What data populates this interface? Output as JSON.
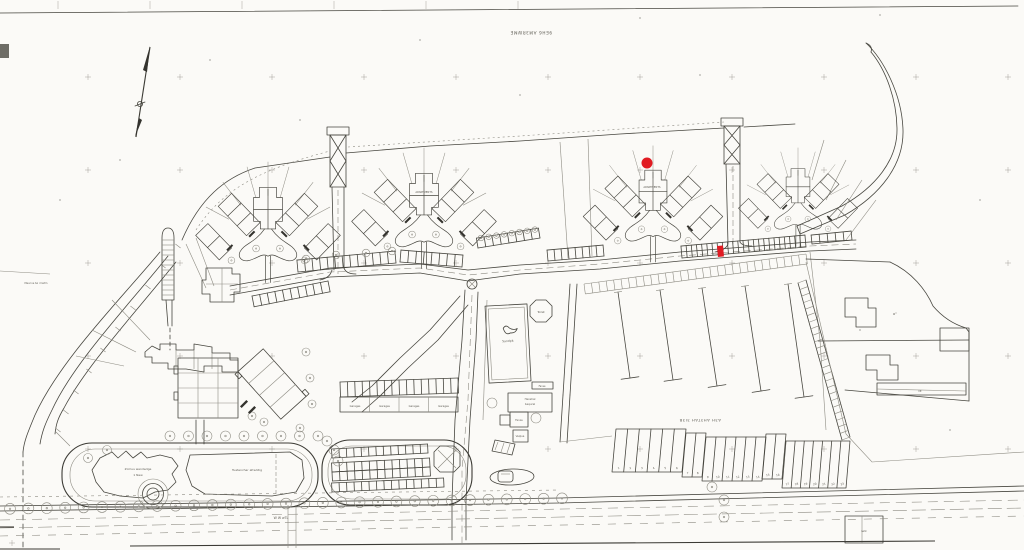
{
  "document": {
    "kind": "development site plan (scanned drawing)"
  },
  "colors": {
    "paper": "#fbfaf7",
    "ink": "#47463f",
    "faint": "#8e8c83",
    "red": "#e11b22"
  },
  "street_labels": {
    "top": "9EH6 AM3RWME",
    "south": "A3H AH3TAH 3I3B"
  },
  "labels": {
    "apartments_b": "APARTMENTS",
    "apartments_c": "APARTMENTS",
    "toilet": "Toilet",
    "sandpit": "Sandpit",
    "amenity_1a": "Zcmus wandedge",
    "amenity_1b": "1 New",
    "amenity_2": "Tuatenchar afreddig",
    "garage_band": [
      "Garages",
      "Garages",
      "Garages",
      "Garages"
    ],
    "building_1a": "Hexshal",
    "building_1b": "bequrel",
    "building_2": "Fanxe",
    "building_3": "Veqlua",
    "building_4": "Fanse",
    "right_plot_note": "o''",
    "strip_rect_label": "lllt",
    "bottom_right_rect_label": "Iwlk",
    "note_left": "Mea lne tw i hwtm",
    "railway_note": "W W wTL"
  },
  "garage_numbers": [
    "1",
    "2",
    "3",
    "4",
    "5",
    "6",
    "7",
    "8",
    "9",
    "10",
    "11",
    "12",
    "13",
    "14",
    "15",
    "16",
    "17",
    "18",
    "19",
    "20",
    "21",
    "22",
    "23"
  ],
  "markers": {
    "plot_dot": {
      "x": 647,
      "y": 163,
      "r": 5.5,
      "color": "#e11b22"
    },
    "parking_bay": {
      "x": 717,
      "y": 246,
      "w": 6,
      "h": 11,
      "color": "#e11b22"
    }
  }
}
